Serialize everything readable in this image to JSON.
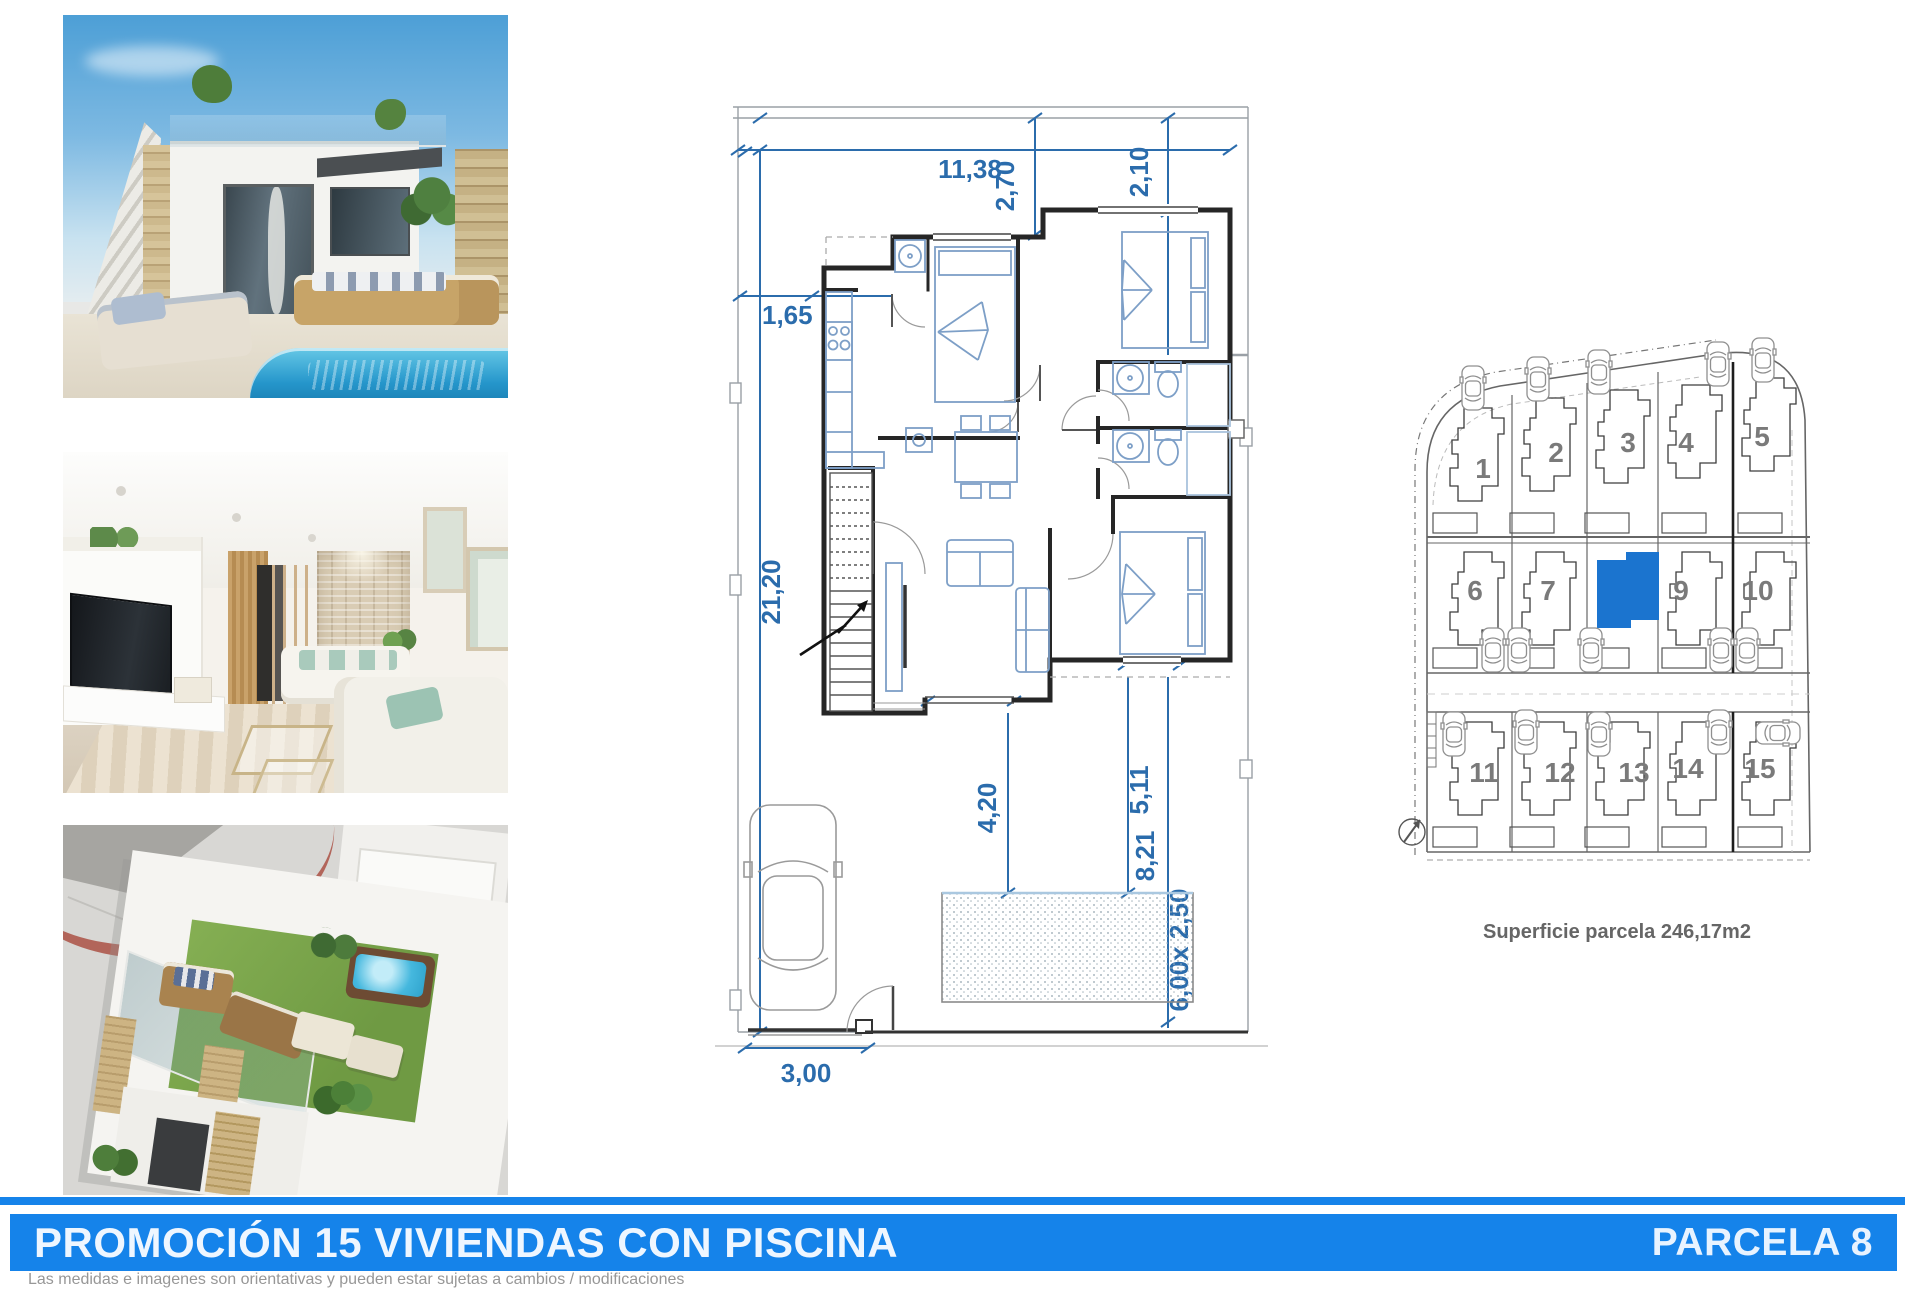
{
  "floorplan": {
    "dimensions": {
      "width_top": "11,38",
      "offset_mid": "2,70",
      "offset_right": "2,10",
      "left_upper": "1,65",
      "depth_left": "21,20",
      "court_a": "4,20",
      "court_b": "5,11",
      "court_c": "8,21",
      "pool_size": "6,00x 2,50",
      "entrance": "3,00"
    }
  },
  "siteplan": {
    "parcels": [
      "1",
      "2",
      "3",
      "4",
      "5",
      "6",
      "7",
      "9",
      "10",
      "11",
      "12",
      "13",
      "14",
      "15"
    ],
    "highlighted_parcel": "8",
    "area_label": "Superficie parcela 246,17m2"
  },
  "footer": {
    "title": "PROMOCIÓN 15 VIVIENDAS CON PISCINA",
    "parcel_label": "PARCELA 8",
    "disclaimer": "Las medidas e imagenes son orientativas y pueden estar sujetas a cambios / modificaciones"
  },
  "colors": {
    "banner_blue": "#1583ea",
    "parcel_highlight": "#1b74cf",
    "dimension_blue": "#2b6cac"
  }
}
